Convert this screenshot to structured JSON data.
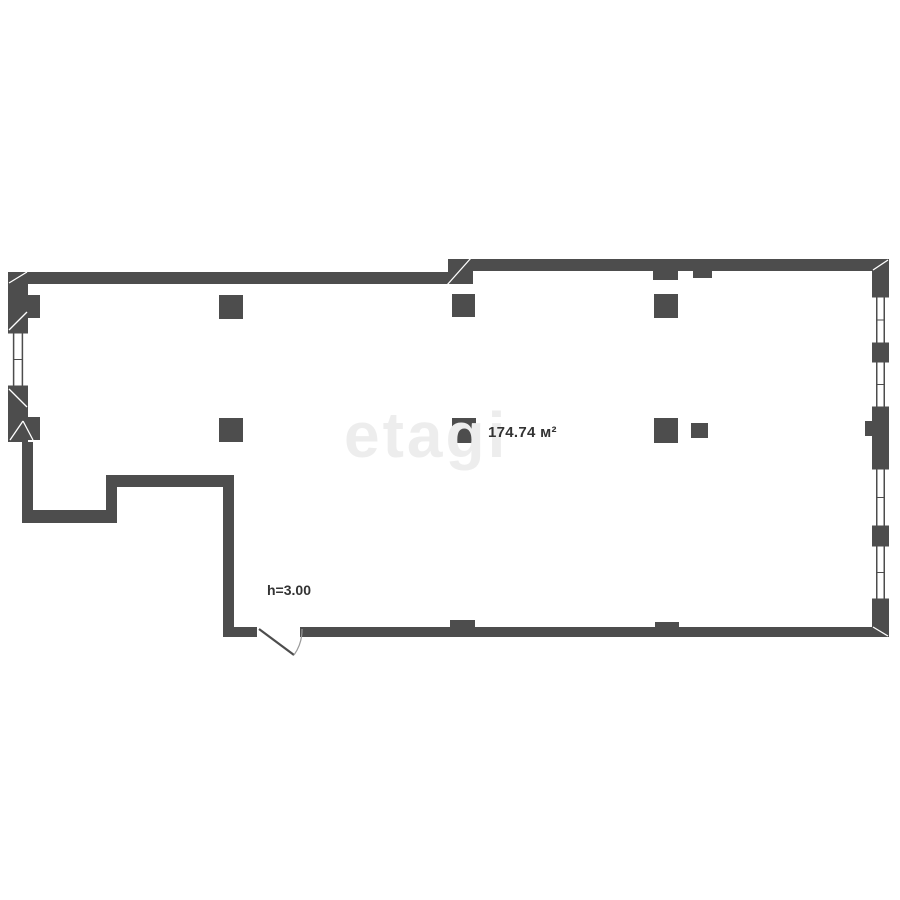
{
  "labels": {
    "area": "174.74 м²",
    "height": "h=3.00",
    "watermark": "etagi"
  },
  "colors": {
    "background": "#ffffff",
    "wall": "#4d4d4d",
    "joint_line": "#ffffff",
    "window_frame": "#4d4d4d",
    "door_leaf": "#4d4d4d",
    "door_arc": "#9a9a9a",
    "text": "#333333",
    "watermark": "#ededed"
  },
  "floorplan": {
    "walls": [
      {
        "x": 8,
        "y": 272,
        "w": 465,
        "h": 12
      },
      {
        "x": 448,
        "y": 259,
        "w": 441,
        "h": 12
      },
      {
        "x": 448,
        "y": 259,
        "w": 25,
        "h": 25
      },
      {
        "x": 8,
        "y": 272,
        "w": 20,
        "h": 60
      },
      {
        "x": 8,
        "y": 387,
        "w": 20,
        "h": 55
      },
      {
        "x": 22,
        "y": 442,
        "w": 11,
        "h": 81
      },
      {
        "x": 22,
        "y": 510,
        "w": 95,
        "h": 13
      },
      {
        "x": 106,
        "y": 475,
        "w": 11,
        "h": 48
      },
      {
        "x": 106,
        "y": 475,
        "w": 128,
        "h": 12
      },
      {
        "x": 223,
        "y": 475,
        "w": 11,
        "h": 162
      },
      {
        "x": 225,
        "y": 627,
        "w": 664,
        "h": 10
      },
      {
        "x": 872,
        "y": 259,
        "w": 17,
        "h": 37
      },
      {
        "x": 872,
        "y": 344,
        "w": 17,
        "h": 17
      },
      {
        "x": 872,
        "y": 408,
        "w": 17,
        "h": 60
      },
      {
        "x": 872,
        "y": 527,
        "w": 17,
        "h": 18
      },
      {
        "x": 872,
        "y": 600,
        "w": 17,
        "h": 37
      }
    ],
    "columns": [
      {
        "x": 219,
        "y": 295,
        "w": 24,
        "h": 24
      },
      {
        "x": 452,
        "y": 294,
        "w": 23,
        "h": 23
      },
      {
        "x": 654,
        "y": 294,
        "w": 24,
        "h": 24
      },
      {
        "x": 219,
        "y": 418,
        "w": 24,
        "h": 24
      },
      {
        "x": 452,
        "y": 418,
        "w": 24,
        "h": 25
      },
      {
        "x": 654,
        "y": 418,
        "w": 24,
        "h": 25
      },
      {
        "x": 691,
        "y": 423,
        "w": 17,
        "h": 15
      }
    ],
    "pilasters": [
      {
        "x": 28,
        "y": 295,
        "w": 12,
        "h": 23
      },
      {
        "x": 28,
        "y": 417,
        "w": 12,
        "h": 23
      },
      {
        "x": 653,
        "y": 271,
        "w": 25,
        "h": 9
      },
      {
        "x": 693,
        "y": 271,
        "w": 19,
        "h": 7
      },
      {
        "x": 865,
        "y": 421,
        "w": 8,
        "h": 15
      },
      {
        "x": 450,
        "y": 620,
        "w": 25,
        "h": 8
      },
      {
        "x": 655,
        "y": 622,
        "w": 24,
        "h": 8
      }
    ],
    "windows": [
      {
        "x": 8,
        "y": 332,
        "w": 20,
        "h": 55
      },
      {
        "x": 872,
        "y": 296,
        "w": 17,
        "h": 48
      },
      {
        "x": 872,
        "y": 361,
        "w": 17,
        "h": 47
      },
      {
        "x": 872,
        "y": 468,
        "w": 17,
        "h": 59
      },
      {
        "x": 872,
        "y": 545,
        "w": 17,
        "h": 55
      }
    ],
    "door": {
      "gap": {
        "x": 257,
        "y": 624,
        "w": 43,
        "h": 15
      },
      "leaf": {
        "x1": 259,
        "y1": 629,
        "x2": 294,
        "y2": 655
      },
      "arc": "M 294 655 A 43 43 0 0 0 302 629"
    },
    "joint_lines": [
      {
        "x1": 9,
        "y1": 283,
        "x2": 27,
        "y2": 272
      },
      {
        "x1": 9,
        "y1": 330,
        "x2": 27,
        "y2": 312
      },
      {
        "x1": 9,
        "y1": 389,
        "x2": 27,
        "y2": 407
      },
      {
        "x1": 10,
        "y1": 440,
        "x2": 23,
        "y2": 421
      },
      {
        "x1": 23,
        "y1": 421,
        "x2": 33,
        "y2": 440
      },
      {
        "x1": 447,
        "y1": 285,
        "x2": 471,
        "y2": 258
      },
      {
        "x1": 873,
        "y1": 270,
        "x2": 888,
        "y2": 260
      },
      {
        "x1": 873,
        "y1": 627,
        "x2": 888,
        "y2": 636
      }
    ]
  }
}
